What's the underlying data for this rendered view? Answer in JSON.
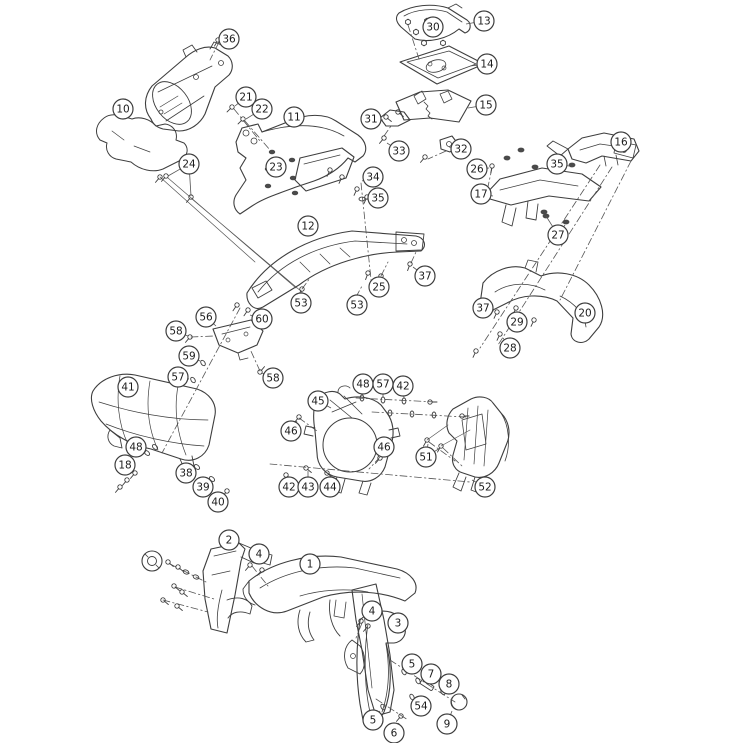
{
  "diagram": {
    "kind": "exploded-parts-diagram",
    "background_color": "#ffffff",
    "line_color": "#3e3e3e",
    "leader_color": "#555555",
    "callout_fill": "#ffffff",
    "callout_radius": 10
  },
  "callouts": [
    {
      "label": "36",
      "x": 229,
      "y": 39,
      "leaders": [
        [
          218,
          42
        ]
      ]
    },
    {
      "label": "10",
      "x": 123,
      "y": 109,
      "leaders": []
    },
    {
      "label": "21",
      "x": 246,
      "y": 97,
      "leaders": [
        [
          235,
          106
        ]
      ]
    },
    {
      "label": "22",
      "x": 262,
      "y": 109,
      "leaders": [
        [
          246,
          119
        ]
      ]
    },
    {
      "label": "11",
      "x": 294,
      "y": 117,
      "leaders": []
    },
    {
      "label": "24",
      "x": 189,
      "y": 164,
      "leaders": [
        [
          168,
          176
        ],
        [
          191,
          196
        ]
      ]
    },
    {
      "label": "23",
      "x": 276,
      "y": 167,
      "leaders": []
    },
    {
      "label": "12",
      "x": 308,
      "y": 226,
      "leaders": []
    },
    {
      "label": "13",
      "x": 484,
      "y": 21,
      "leaders": [
        [
          466,
          24
        ]
      ]
    },
    {
      "label": "30",
      "x": 433,
      "y": 27,
      "leaders": []
    },
    {
      "label": "14",
      "x": 487,
      "y": 64,
      "leaders": [
        [
          470,
          66
        ]
      ]
    },
    {
      "label": "15",
      "x": 486,
      "y": 105,
      "leaders": [
        [
          468,
          108
        ]
      ]
    },
    {
      "label": "31",
      "x": 371,
      "y": 119,
      "leaders": [
        [
          383,
          120
        ]
      ]
    },
    {
      "label": "33",
      "x": 399,
      "y": 151,
      "leaders": [
        [
          387,
          143
        ]
      ]
    },
    {
      "label": "32",
      "x": 461,
      "y": 149,
      "leaders": [
        [
          449,
          147
        ]
      ]
    },
    {
      "label": "16",
      "x": 621,
      "y": 142,
      "leaders": []
    },
    {
      "label": "35",
      "x": 557,
      "y": 164,
      "leaders": [
        [
          569,
          166
        ]
      ]
    },
    {
      "label": "26",
      "x": 477,
      "y": 169,
      "leaders": [
        [
          489,
          168
        ]
      ]
    },
    {
      "label": "17",
      "x": 481,
      "y": 194,
      "leaders": [
        [
          493,
          196
        ]
      ]
    },
    {
      "label": "34",
      "x": 373,
      "y": 177,
      "leaders": [
        [
          362,
          181
        ]
      ]
    },
    {
      "label": "35",
      "x": 378,
      "y": 198,
      "leaders": [
        [
          365,
          199
        ]
      ]
    },
    {
      "label": "27",
      "x": 558,
      "y": 235,
      "leaders": [
        [
          546,
          216
        ],
        [
          565,
          225
        ]
      ]
    },
    {
      "label": "37",
      "x": 425,
      "y": 276,
      "leaders": [
        [
          413,
          267
        ]
      ]
    },
    {
      "label": "25",
      "x": 379,
      "y": 287,
      "leaders": [
        [
          379,
          278
        ]
      ]
    },
    {
      "label": "53",
      "x": 301,
      "y": 303,
      "leaders": [
        [
          302,
          292
        ]
      ]
    },
    {
      "label": "53",
      "x": 357,
      "y": 305,
      "leaders": [
        [
          356,
          299
        ]
      ]
    },
    {
      "label": "37",
      "x": 483,
      "y": 308,
      "leaders": [
        [
          494,
          311
        ]
      ]
    },
    {
      "label": "29",
      "x": 517,
      "y": 322,
      "leaders": [
        [
          513,
          313
        ]
      ]
    },
    {
      "label": "20",
      "x": 585,
      "y": 313,
      "leaders": []
    },
    {
      "label": "28",
      "x": 510,
      "y": 348,
      "leaders": [
        [
          503,
          338
        ]
      ]
    },
    {
      "label": "56",
      "x": 206,
      "y": 317,
      "leaders": [
        [
          216,
          326
        ]
      ]
    },
    {
      "label": "60",
      "x": 262,
      "y": 319,
      "leaders": [
        [
          250,
          315
        ]
      ]
    },
    {
      "label": "58",
      "x": 176,
      "y": 331,
      "leaders": [
        [
          188,
          336
        ]
      ]
    },
    {
      "label": "59",
      "x": 189,
      "y": 356,
      "leaders": [
        [
          200,
          361
        ]
      ]
    },
    {
      "label": "57",
      "x": 178,
      "y": 377,
      "leaders": [
        [
          189,
          379
        ]
      ]
    },
    {
      "label": "58",
      "x": 273,
      "y": 378,
      "leaders": [
        [
          262,
          373
        ]
      ]
    },
    {
      "label": "41",
      "x": 128,
      "y": 387,
      "leaders": []
    },
    {
      "label": "48",
      "x": 136,
      "y": 447,
      "leaders": [
        [
          146,
          452
        ]
      ]
    },
    {
      "label": "18",
      "x": 125,
      "y": 465,
      "leaders": [
        [
          134,
          471
        ]
      ]
    },
    {
      "label": "38",
      "x": 186,
      "y": 473,
      "leaders": [
        [
          195,
          469
        ]
      ]
    },
    {
      "label": "39",
      "x": 203,
      "y": 487,
      "leaders": [
        [
          210,
          481
        ]
      ]
    },
    {
      "label": "40",
      "x": 218,
      "y": 502,
      "leaders": [
        [
          225,
          494
        ]
      ]
    },
    {
      "label": "45",
      "x": 318,
      "y": 401,
      "leaders": [
        [
          331,
          408
        ]
      ]
    },
    {
      "label": "48",
      "x": 363,
      "y": 384,
      "leaders": [
        [
          362,
          395
        ]
      ]
    },
    {
      "label": "57",
      "x": 383,
      "y": 384,
      "leaders": [
        [
          383,
          397
        ]
      ]
    },
    {
      "label": "42",
      "x": 403,
      "y": 386,
      "leaders": [
        [
          404,
          398
        ]
      ]
    },
    {
      "label": "46",
      "x": 291,
      "y": 431,
      "leaders": [
        [
          297,
          421
        ]
      ]
    },
    {
      "label": "46",
      "x": 384,
      "y": 447,
      "leaders": [
        [
          380,
          455
        ]
      ]
    },
    {
      "label": "51",
      "x": 426,
      "y": 457,
      "leaders": [
        [
          428,
          444
        ],
        [
          440,
          448
        ]
      ]
    },
    {
      "label": "52",
      "x": 485,
      "y": 487,
      "leaders": [
        [
          472,
          480
        ]
      ]
    },
    {
      "label": "42",
      "x": 289,
      "y": 487,
      "leaders": [
        [
          288,
          477
        ]
      ]
    },
    {
      "label": "43",
      "x": 308,
      "y": 487,
      "leaders": [
        [
          308,
          471
        ]
      ]
    },
    {
      "label": "44",
      "x": 330,
      "y": 487,
      "leaders": [
        [
          329,
          476
        ]
      ]
    },
    {
      "label": "2",
      "x": 229,
      "y": 540,
      "leaders": [
        [
          233,
          549
        ]
      ]
    },
    {
      "label": "4",
      "x": 259,
      "y": 554,
      "leaders": [
        [
          257,
          563
        ]
      ]
    },
    {
      "label": "1",
      "x": 310,
      "y": 564,
      "leaders": []
    },
    {
      "label": "4",
      "x": 372,
      "y": 611,
      "leaders": [
        [
          366,
          620
        ]
      ]
    },
    {
      "label": "3",
      "x": 398,
      "y": 623,
      "leaders": [
        [
          391,
          630
        ]
      ]
    },
    {
      "label": "5",
      "x": 412,
      "y": 664,
      "leaders": [
        [
          406,
          672
        ]
      ]
    },
    {
      "label": "7",
      "x": 431,
      "y": 674,
      "leaders": [
        [
          428,
          683
        ]
      ]
    },
    {
      "label": "8",
      "x": 449,
      "y": 684,
      "leaders": [
        [
          445,
          691
        ]
      ]
    },
    {
      "label": "54",
      "x": 421,
      "y": 706,
      "leaders": [
        [
          414,
          699
        ]
      ]
    },
    {
      "label": "9",
      "x": 447,
      "y": 724,
      "leaders": [
        [
          452,
          711
        ]
      ]
    },
    {
      "label": "5",
      "x": 373,
      "y": 720,
      "leaders": [
        [
          380,
          711
        ]
      ]
    },
    {
      "label": "6",
      "x": 394,
      "y": 733,
      "leaders": [
        [
          399,
          723
        ]
      ]
    }
  ]
}
